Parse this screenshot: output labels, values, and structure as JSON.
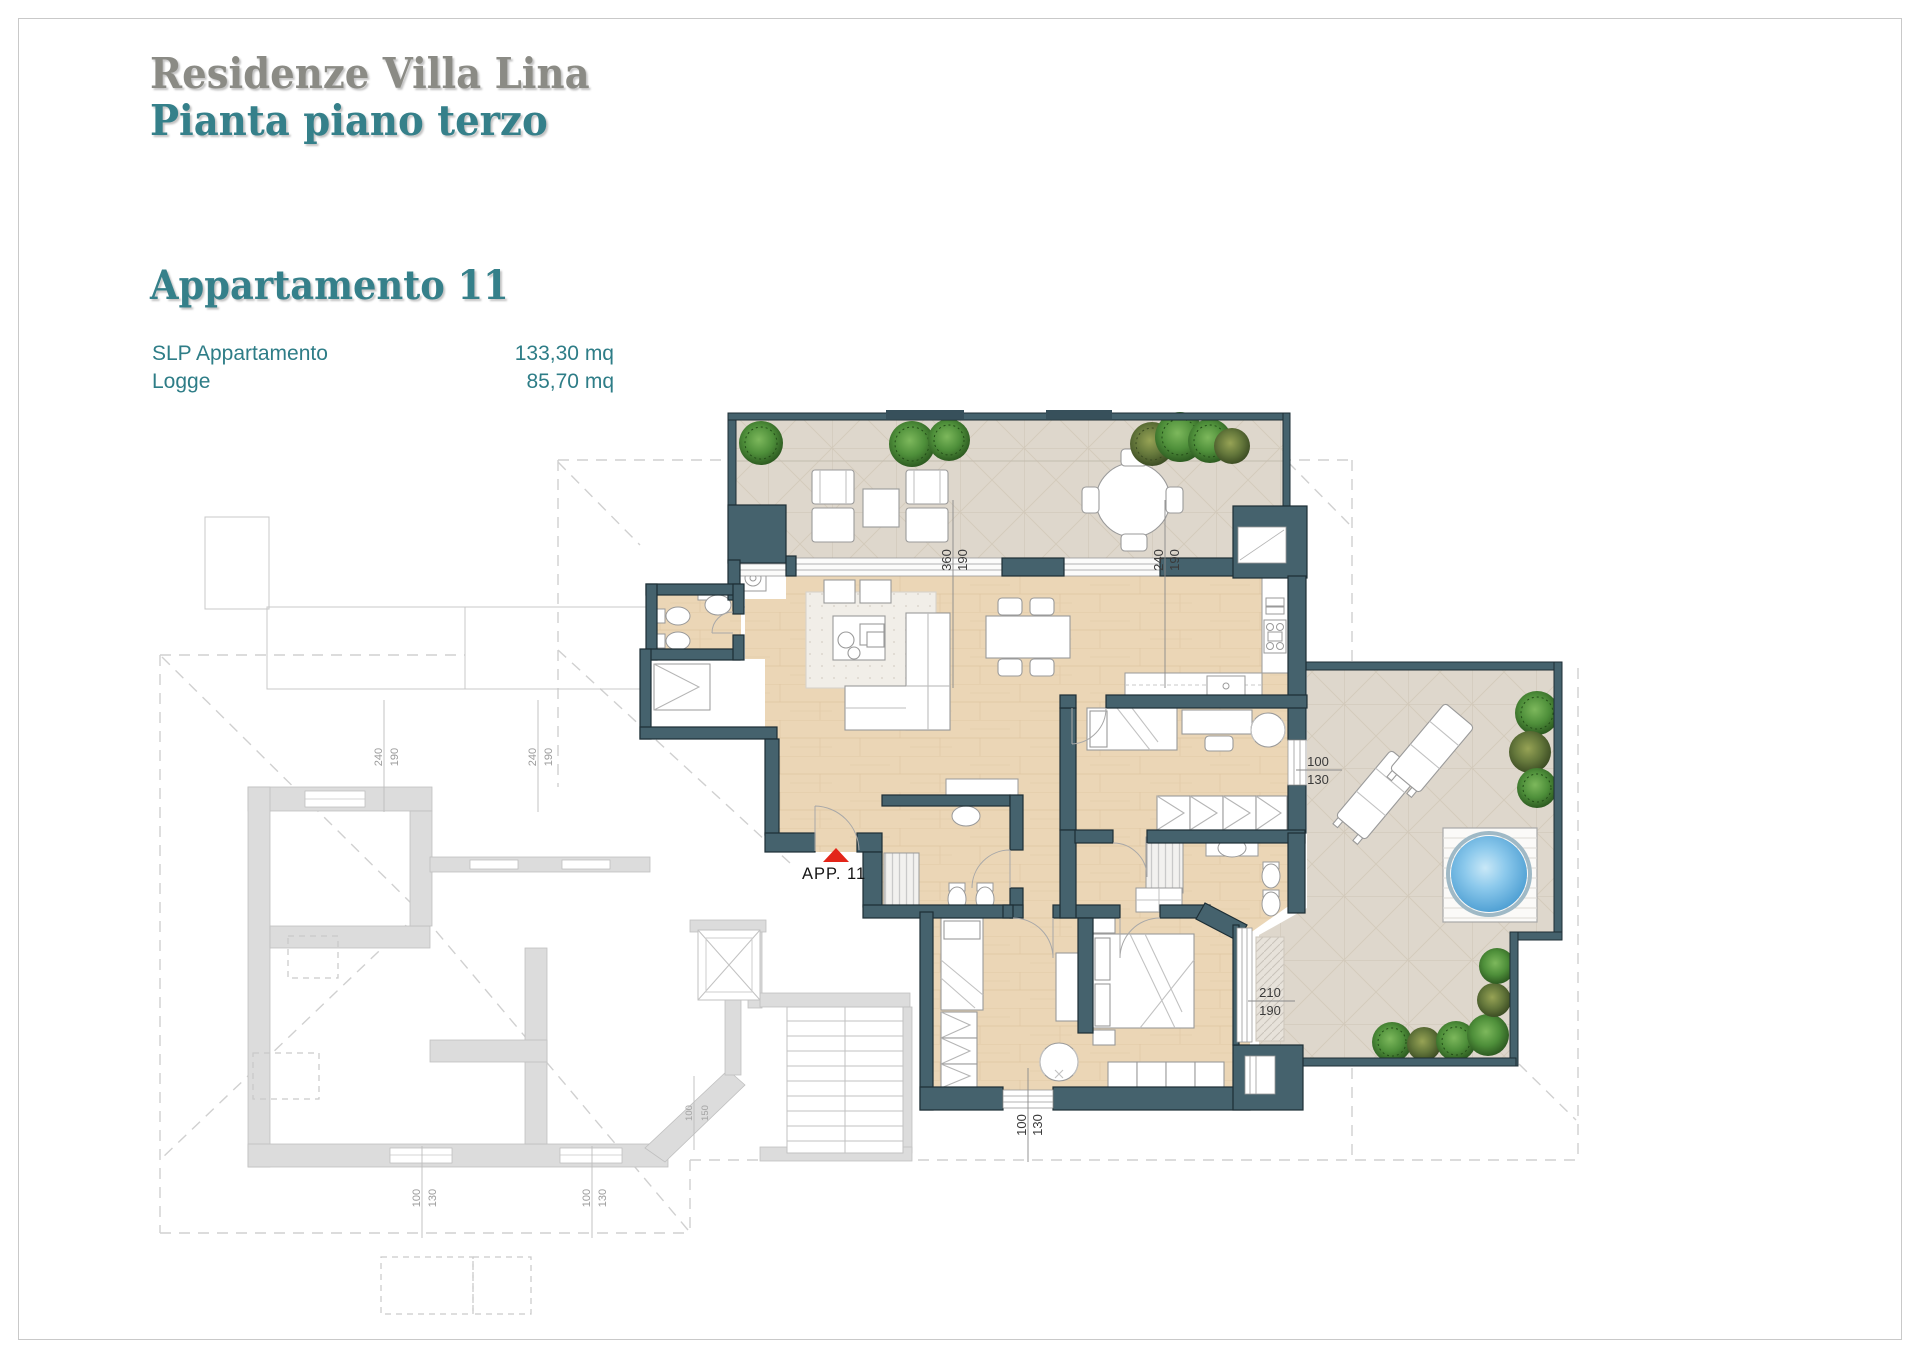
{
  "header": {
    "project_title": "Residenze Villa Lina",
    "plan_subtitle": "Pianta piano terzo",
    "apartment_title": "Appartamento 11",
    "area_rows": [
      {
        "label": "SLP Appartamento",
        "value": "133,30 mq"
      },
      {
        "label": "Logge",
        "value": "85,70 mq"
      }
    ]
  },
  "plan": {
    "unit_marker": {
      "label": "APP. 11"
    },
    "dimensions": {
      "terrace_opening_a": {
        "w": "360",
        "h": "190"
      },
      "terrace_opening_b": {
        "w": "240",
        "h": "190"
      },
      "window_east": {
        "w": "100",
        "h": "130"
      },
      "window_southeast": {
        "w": "210",
        "h": "190"
      },
      "window_south": {
        "w": "100",
        "h": "130"
      },
      "ghost_opening_a": {
        "w": "240",
        "h": "190"
      },
      "ghost_opening_b": {
        "w": "240",
        "h": "190"
      },
      "ghost_window_a": {
        "w": "100",
        "h": "130"
      },
      "ghost_window_b": {
        "w": "100",
        "h": "130"
      },
      "ghost_window_c": {
        "w": "100",
        "h": "150"
      }
    },
    "colors": {
      "wall": "#45626d",
      "wood_floor": "#ebd6b6",
      "tile_floor": "#ded7cc",
      "ghost_gray": "#dcdcdc",
      "accent_teal": "#2e7d87",
      "title_gray": "#8b8b85",
      "pool_blue": "#58a8d8",
      "plant_green": "#3c7a33",
      "marker_red": "#e32519"
    }
  }
}
